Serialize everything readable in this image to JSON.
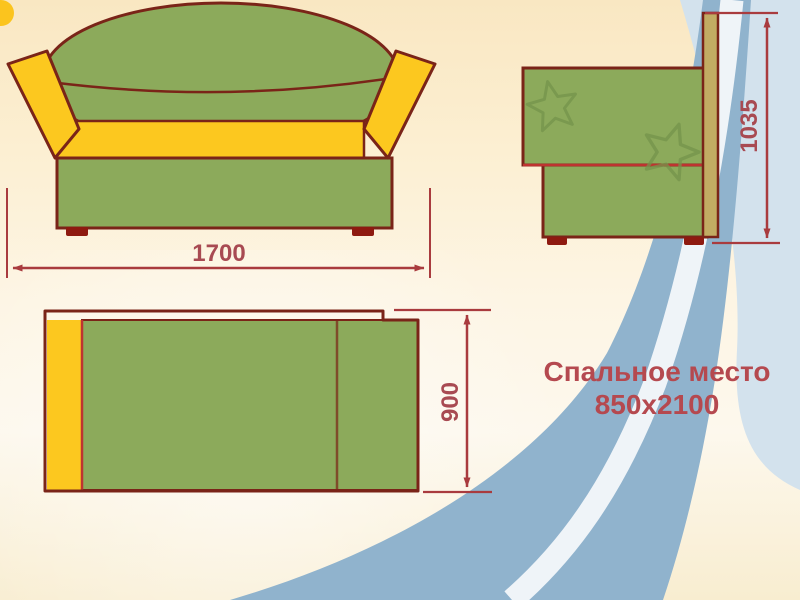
{
  "diagram": {
    "type": "furniture-dimension-drawing",
    "dimensions": {
      "front_width": "1700",
      "side_height": "1035",
      "top_depth": "900"
    },
    "note": {
      "line1": "Спальное место",
      "line2": "850x2100"
    },
    "colors": {
      "upholstery_green": "#8caa5b",
      "accent_yellow": "#fcc81f",
      "outline_dark_red": "#7a2418",
      "divider_red": "#bf3330",
      "dimension_red": "#a93b3e",
      "dimension_label_red": "#a84a52",
      "note_text_red": "#b5494f",
      "back_panel_tan": "#c2ac63",
      "star_motif_green": "#75944b",
      "ribbon_blue": "#90b3cd",
      "ribbon_pale_blue": "#d3e2ed",
      "background_cream": "#fcefd2"
    }
  }
}
